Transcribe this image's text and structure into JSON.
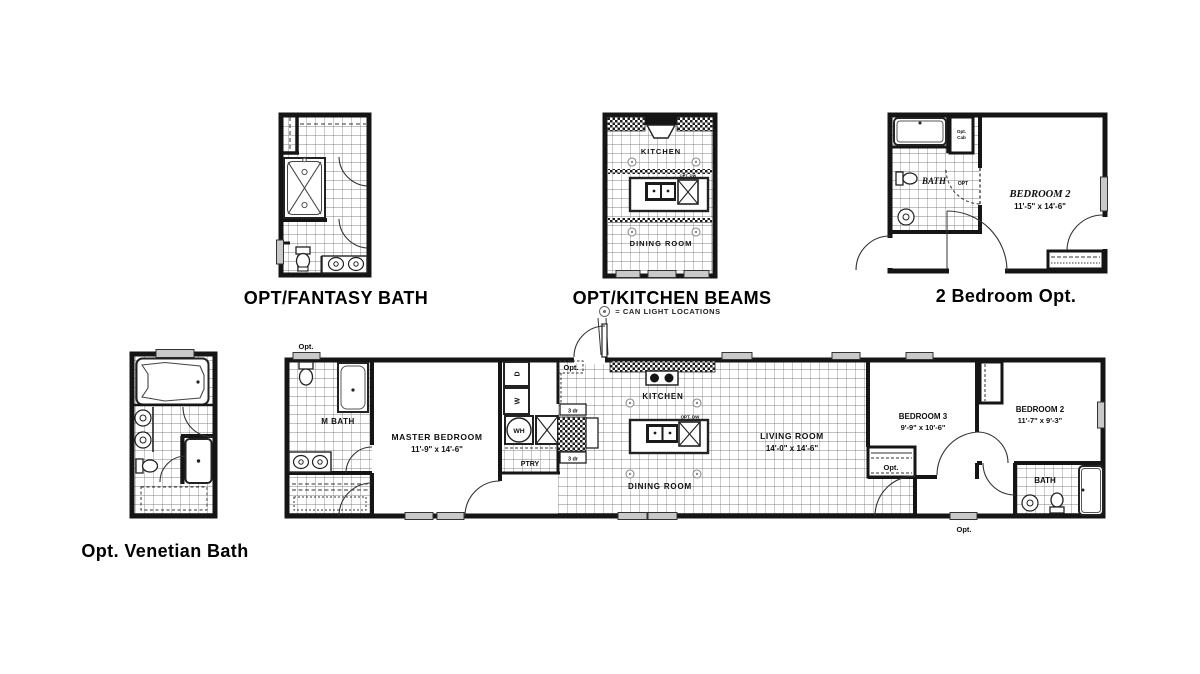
{
  "sheet": {
    "background": "#ffffff"
  },
  "colors": {
    "wall": "#151515",
    "tile_line": "#555555",
    "window": "#c9c9c9"
  },
  "titles": {
    "fantasy_bath": "OPT/FANTASY BATH",
    "kitchen_beams": "OPT/KITCHEN BEAMS",
    "two_bedroom": "2 Bedroom Opt.",
    "venetian_bath": "Opt. Venetian Bath"
  },
  "legend": {
    "symbol": "can-light",
    "text": "= CAN LIGHT LOCATIONS"
  },
  "kitchen_beams_plan": {
    "kitchen": "KITCHEN",
    "dining": "DINING ROOM",
    "opt_dw": "OPT. DW"
  },
  "two_bedroom_plan": {
    "bath": "BATH",
    "opt_cab_line1": "Opt.",
    "opt_cab_line2": "Cab",
    "opt": "OPT",
    "bedroom2": "BEDROOM 2",
    "bedroom2_dims": "11'-5\" x 14'-6\""
  },
  "main_plan": {
    "opt_top": "Opt.",
    "opt_entry": "Opt.",
    "opt_closet": "Opt.",
    "opt_window": "Opt.",
    "m_bath": "M BATH",
    "master_bedroom": "MASTER BEDROOM",
    "master_bedroom_dims": "11'-9\" x 14'-6\"",
    "dryer": "D",
    "washer": "W",
    "water_heater": "WH",
    "pantry": "PTRY",
    "cab_3dr": "3 dr",
    "kitchen": "KITCHEN",
    "opt_dw": "OPT. DW",
    "dining": "DINING ROOM",
    "living": "LIVING ROOM",
    "living_dims": "14'-0\" x 14'-6\"",
    "bedroom3": "BEDROOM 3",
    "bedroom3_dims": "9'-9\" x 10'-6\"",
    "bedroom2": "BEDROOM 2",
    "bedroom2_dims": "11'-7\" x 9'-3\"",
    "bath": "BATH"
  }
}
